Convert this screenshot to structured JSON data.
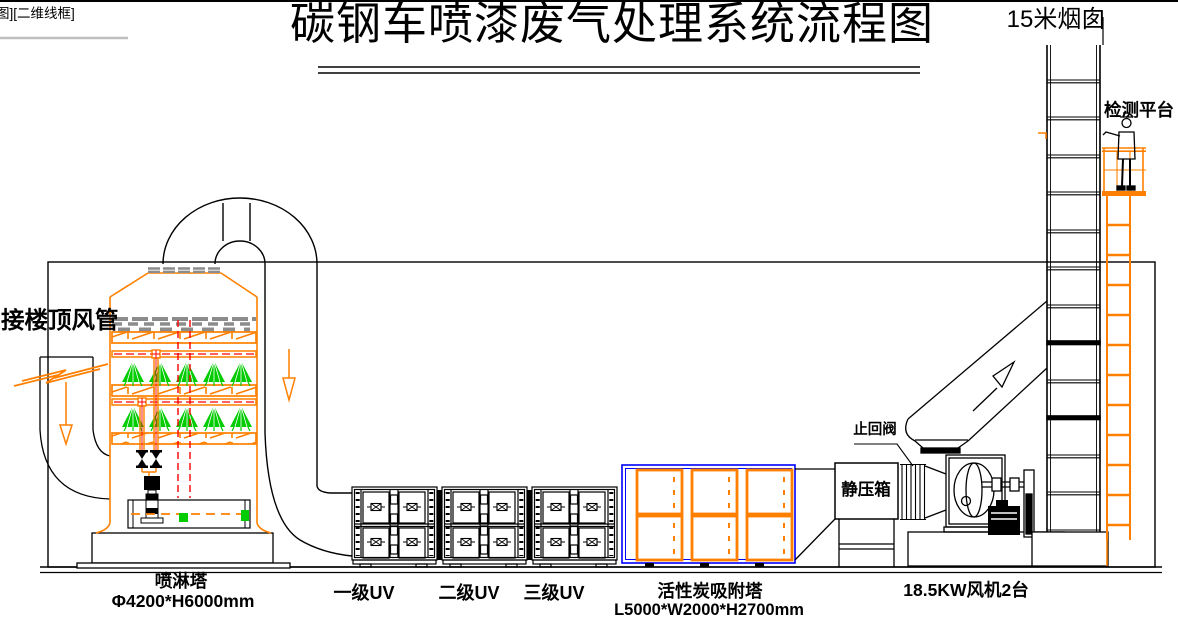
{
  "window": {
    "corner_label": "图][二维线框]"
  },
  "title": "碳钢车喷漆废气处理系统流程图",
  "flow": {
    "inlet": {
      "label": "接楼顶风管"
    },
    "spray_tower": {
      "name": "喷淋塔",
      "spec": "Φ4200*H6000mm"
    },
    "uv_stages": [
      {
        "label": "一级UV"
      },
      {
        "label": "二级UV"
      },
      {
        "label": "三级UV"
      }
    ],
    "carbon_tower": {
      "name": "活性炭吸附塔",
      "spec": "L5000*W2000*H2700mm"
    },
    "plenum": {
      "label": "静压箱"
    },
    "check_valve": {
      "label": "止回阀"
    },
    "fan": {
      "label": "18.5KW风机2台"
    },
    "chimney": {
      "label": "15米烟囱"
    },
    "platform": {
      "label": "检测平台"
    }
  },
  "colors": {
    "line": "#000000",
    "equipment_orange": "#ff8000",
    "spray_green": "#00cc00",
    "pipe_red": "#ff0000",
    "carbon_blue": "#0000ff",
    "demister_gray": "#8c8c8c",
    "background": "#ffffff"
  }
}
